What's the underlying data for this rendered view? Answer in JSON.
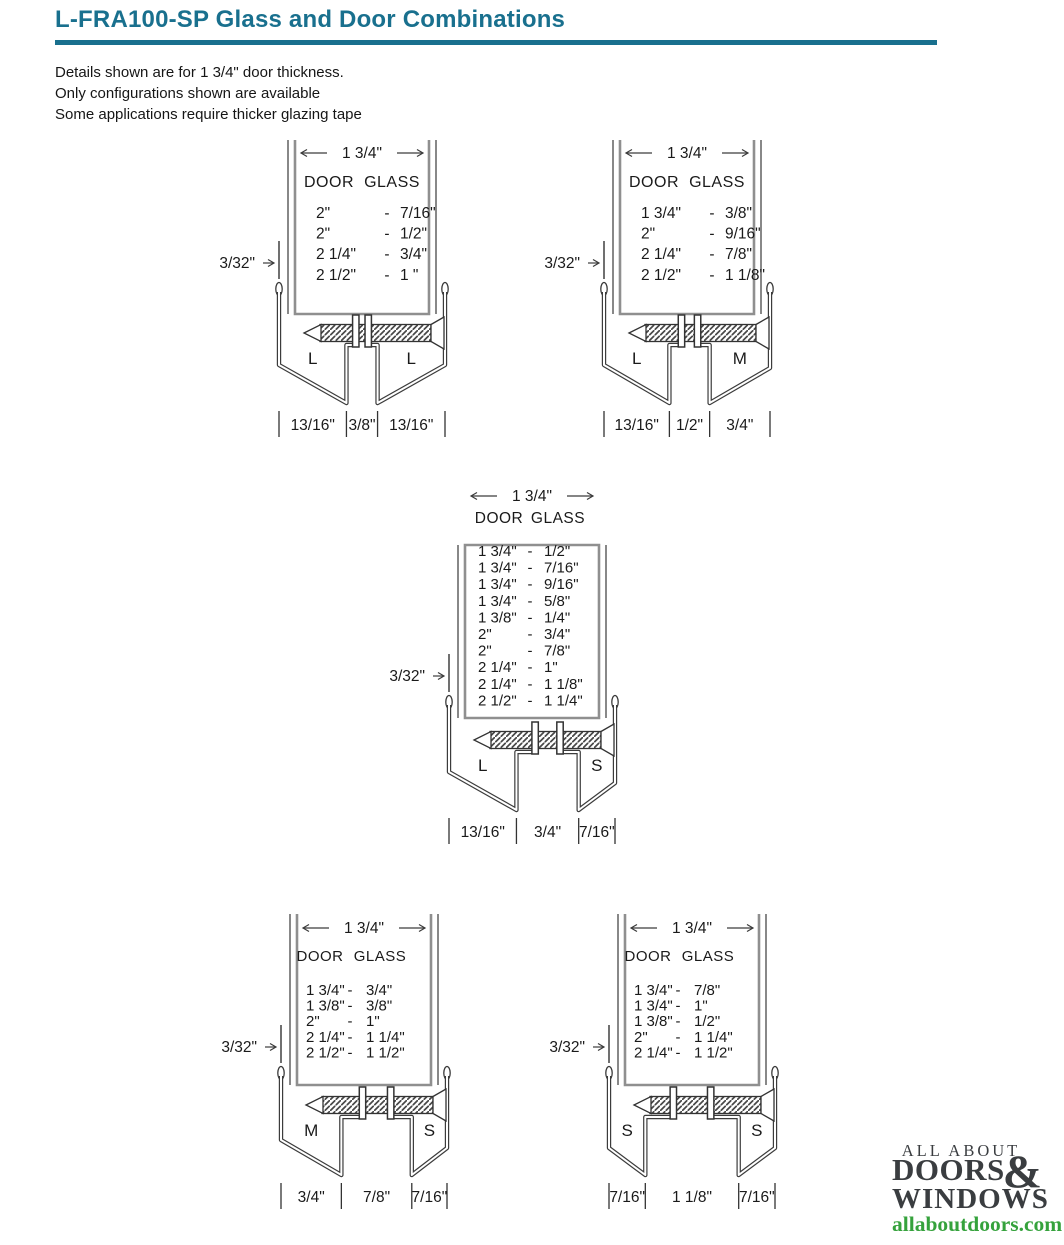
{
  "page": {
    "title": "L-FRA100-SP Glass and Door Combinations",
    "title_color": "#19708e",
    "notes": [
      "Details shown are for 1 3/4\" door thickness.",
      "Only configurations shown are available",
      "Some applications require thicker glazing tape"
    ]
  },
  "diagram_common": {
    "top_dimension": "1 3/4\"",
    "side_dimension": "3/32\"",
    "columns": [
      "DOOR",
      "GLASS"
    ],
    "row_separator": "-"
  },
  "diagrams": [
    {
      "id": "top-left",
      "legs": [
        "L",
        "L"
      ],
      "bottom_dims": [
        "13/16\"",
        "3/8\"",
        "13/16\""
      ],
      "rows": [
        [
          "2\"",
          "7/16\""
        ],
        [
          "2\"",
          "1/2\""
        ],
        [
          "2 1/4\"",
          "3/4\""
        ],
        [
          "2 1/2\"",
          "1 \""
        ]
      ]
    },
    {
      "id": "top-right",
      "legs": [
        "L",
        "M"
      ],
      "bottom_dims": [
        "13/16\"",
        "1/2\"",
        "3/4\""
      ],
      "rows": [
        [
          "1 3/4\"",
          "3/8\""
        ],
        [
          "2\"",
          "9/16\""
        ],
        [
          "2 1/4\"",
          "7/8\""
        ],
        [
          "2 1/2\"",
          "1 1/8\""
        ]
      ]
    },
    {
      "id": "middle",
      "legs": [
        "L",
        "S"
      ],
      "bottom_dims": [
        "13/16\"",
        "3/4\"",
        "7/16\""
      ],
      "rows": [
        [
          "1 3/4\"",
          "1/2\""
        ],
        [
          "1 3/4\"",
          "7/16\""
        ],
        [
          "1 3/4\"",
          "9/16\""
        ],
        [
          "1 3/4\"",
          "5/8\""
        ],
        [
          "1 3/8\"",
          "1/4\""
        ],
        [
          "2\"",
          "3/4\""
        ],
        [
          "2\"",
          "7/8\""
        ],
        [
          "2 1/4\"",
          "1\""
        ],
        [
          "2 1/4\"",
          "1 1/8\""
        ],
        [
          "2 1/2\"",
          "1 1/4\""
        ]
      ]
    },
    {
      "id": "bottom-left",
      "legs": [
        "M",
        "S"
      ],
      "bottom_dims": [
        "3/4\"",
        "7/8\"",
        "7/16\""
      ],
      "rows": [
        [
          "1 3/4\"",
          "3/4\""
        ],
        [
          "1 3/8\"",
          "3/8\""
        ],
        [
          "2\"",
          "1\""
        ],
        [
          "2 1/4\"",
          "1 1/4\""
        ],
        [
          "2 1/2\"",
          "1 1/2\""
        ]
      ]
    },
    {
      "id": "bottom-right",
      "legs": [
        "S",
        "S"
      ],
      "bottom_dims": [
        "7/16\"",
        "1 1/8\"",
        "7/16\""
      ],
      "rows": [
        [
          "1 3/4\"",
          "7/8\""
        ],
        [
          "1 3/4\"",
          "1\""
        ],
        [
          "1 3/8\"",
          "1/2\""
        ],
        [
          "2\"",
          "1 1/4\""
        ],
        [
          "2 1/4\"",
          "1 1/2\""
        ]
      ]
    }
  ],
  "logo": {
    "line1": "ALL ABOUT",
    "line2": "DOORS",
    "ampersand": "&",
    "line3": "WINDOWS",
    "url": "allaboutdoors.com",
    "text_color": "#3a3d40",
    "url_color": "#35a23c"
  }
}
